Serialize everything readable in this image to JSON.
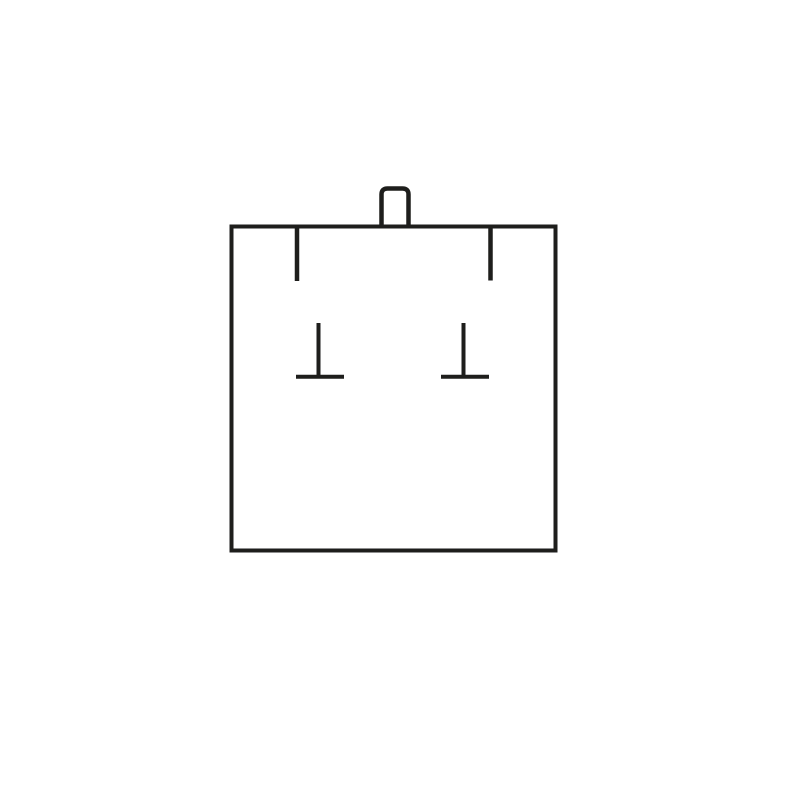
{
  "canvas": {
    "width": 800,
    "height": 800,
    "background_color": "#ffffff"
  },
  "diagram": {
    "description": "line drawing of a square display card with top tab, two hanging slits and two T-shaped post marks",
    "stroke_color": "#1e1e1c",
    "shapes": [
      {
        "name": "box-outline",
        "type": "rect",
        "x": 231.5,
        "y": 226.5,
        "width": 324,
        "height": 324,
        "stroke_width": 4
      },
      {
        "name": "top-tab",
        "type": "path",
        "d": "M 381.5 228 L 381.5 194.5 Q 381.5 188.5 387.5 188.5 L 402.5 188.5 Q 408.5 188.5 408.5 194.5 L 408.5 228",
        "stroke_width": 4.5
      },
      {
        "name": "left-hang-slit",
        "type": "line",
        "x1": 297,
        "y1": 228,
        "x2": 297,
        "y2": 281,
        "stroke_width": 4.5
      },
      {
        "name": "right-hang-slit",
        "type": "line",
        "x1": 490.5,
        "y1": 228,
        "x2": 490.5,
        "y2": 280.5,
        "stroke_width": 4.5
      },
      {
        "name": "left-t-mark-stem",
        "type": "line",
        "x1": 318.5,
        "y1": 323,
        "x2": 318.5,
        "y2": 377,
        "stroke_width": 4
      },
      {
        "name": "left-t-mark-base",
        "type": "line",
        "x1": 296,
        "y1": 376.8,
        "x2": 344,
        "y2": 376.8,
        "stroke_width": 4
      },
      {
        "name": "right-t-mark-stem",
        "type": "line",
        "x1": 463.5,
        "y1": 323,
        "x2": 463.5,
        "y2": 377,
        "stroke_width": 4
      },
      {
        "name": "right-t-mark-base",
        "type": "line",
        "x1": 441,
        "y1": 376.8,
        "x2": 489,
        "y2": 376.8,
        "stroke_width": 4
      }
    ]
  }
}
